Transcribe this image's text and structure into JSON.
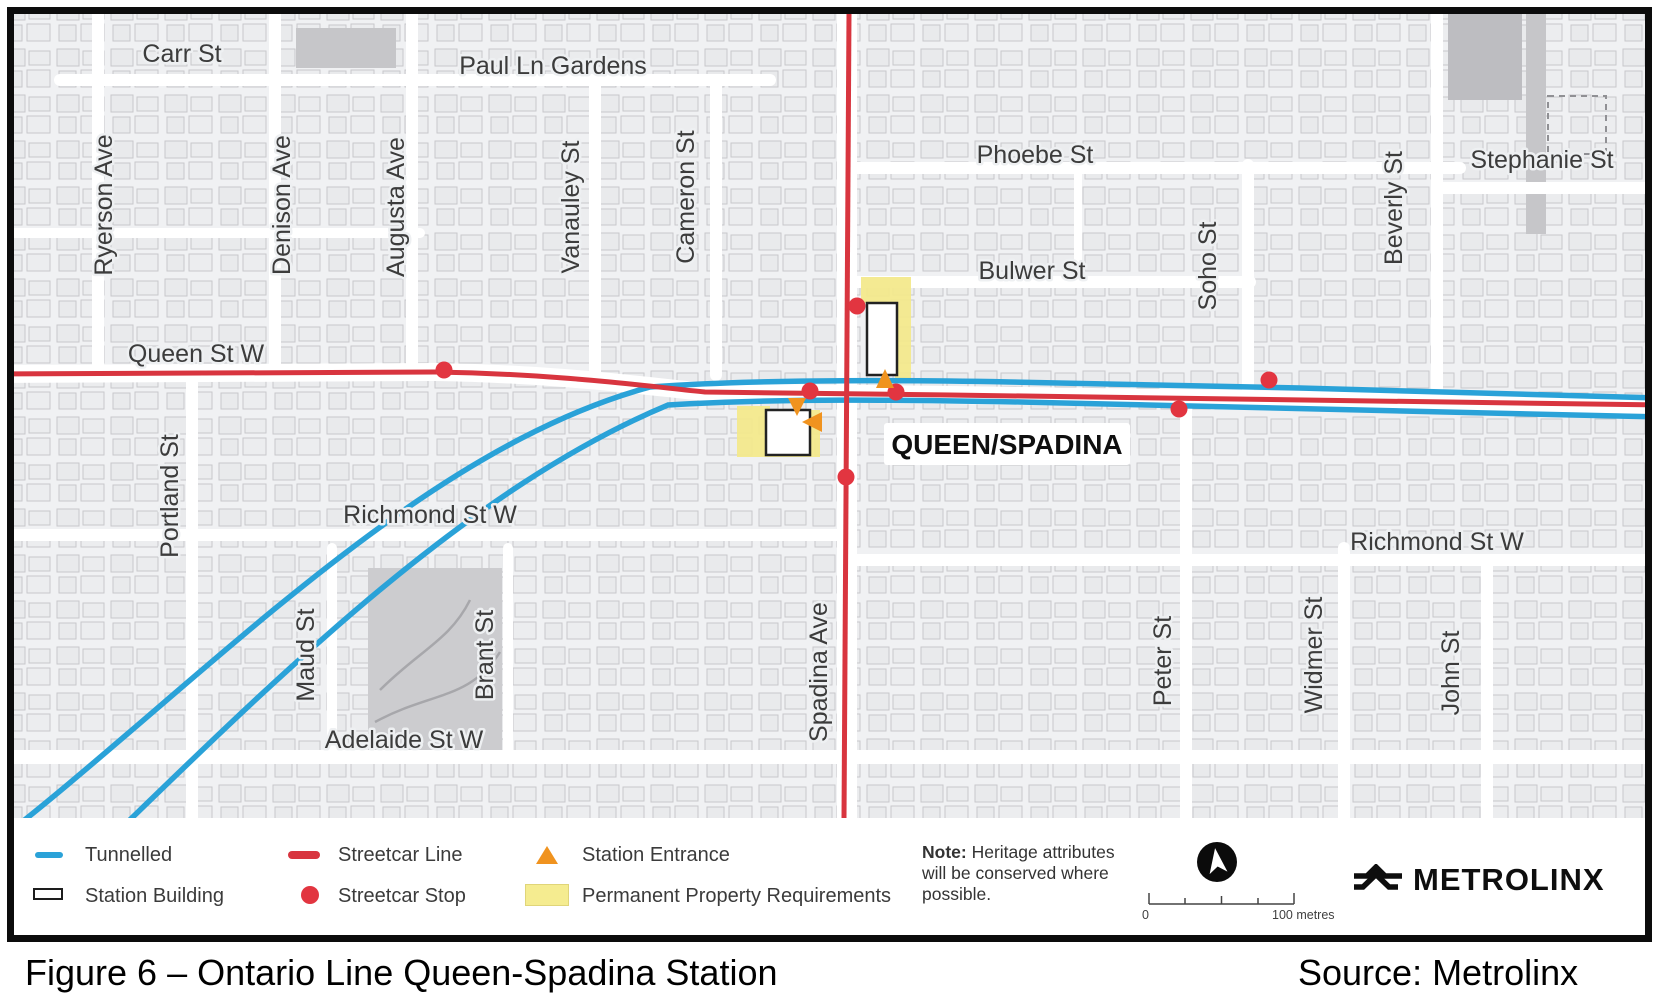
{
  "figure": {
    "caption": "Figure 6 – Ontario Line Queen-Spadina Station",
    "source": "Source: Metrolinx"
  },
  "station": {
    "name": "QUEEN/SPADINA"
  },
  "colors": {
    "tunnel_blue": "#2aa2d8",
    "streetcar_red": "#d8353f",
    "stop_red": "#e23540",
    "entrance_orange": "#f0931f",
    "property_yellow": "#f3e98c",
    "building_outline": "#222222"
  },
  "legend": {
    "items": [
      {
        "id": "tunnelled",
        "label": "Tunnelled"
      },
      {
        "id": "station-building",
        "label": "Station Building"
      },
      {
        "id": "streetcar-line",
        "label": "Streetcar Line"
      },
      {
        "id": "streetcar-stop",
        "label": "Streetcar Stop"
      },
      {
        "id": "station-entrance",
        "label": "Station Entrance"
      },
      {
        "id": "permanent-property",
        "label": "Permanent Property Requirements"
      }
    ],
    "note_bold": "Note:",
    "note_rest": " Heritage attributes will be conserved where possible.",
    "scale": {
      "start_label": "0",
      "end_label": "100 metres"
    },
    "logo_text": "METROLINX"
  },
  "map": {
    "street_labels": [
      {
        "text": "Carr St",
        "x": 182,
        "y": 62,
        "vertical": false
      },
      {
        "text": "Paul Ln Gardens",
        "x": 553,
        "y": 74,
        "vertical": false
      },
      {
        "text": "Phoebe St",
        "x": 1035,
        "y": 163,
        "vertical": false
      },
      {
        "text": "Stephanie St",
        "x": 1542,
        "y": 168,
        "vertical": false
      },
      {
        "text": "Bulwer St",
        "x": 1032,
        "y": 279,
        "vertical": false
      },
      {
        "text": "Queen St W",
        "x": 196,
        "y": 362,
        "vertical": false
      },
      {
        "text": "Richmond St W",
        "x": 430,
        "y": 523,
        "vertical": false
      },
      {
        "text": "Richmond St W",
        "x": 1437,
        "y": 550,
        "vertical": false
      },
      {
        "text": "Adelaide St W",
        "x": 404,
        "y": 748,
        "vertical": false
      },
      {
        "text": "Ryerson Ave",
        "x": 112,
        "y": 205,
        "vertical": true
      },
      {
        "text": "Denison Ave",
        "x": 290,
        "y": 205,
        "vertical": true
      },
      {
        "text": "Augusta Ave",
        "x": 404,
        "y": 207,
        "vertical": true
      },
      {
        "text": "Vanauley St",
        "x": 579,
        "y": 207,
        "vertical": true
      },
      {
        "text": "Cameron St",
        "x": 694,
        "y": 197,
        "vertical": true
      },
      {
        "text": "Portland St",
        "x": 178,
        "y": 496,
        "vertical": true
      },
      {
        "text": "Maud St",
        "x": 314,
        "y": 655,
        "vertical": true
      },
      {
        "text": "Brant St",
        "x": 493,
        "y": 655,
        "vertical": true
      },
      {
        "text": "Spadina Ave",
        "x": 827,
        "y": 672,
        "vertical": true
      },
      {
        "text": "Soho St",
        "x": 1216,
        "y": 266,
        "vertical": true
      },
      {
        "text": "Beverly St",
        "x": 1402,
        "y": 208,
        "vertical": true
      },
      {
        "text": "Peter St",
        "x": 1171,
        "y": 661,
        "vertical": true
      },
      {
        "text": "Widmer St",
        "x": 1322,
        "y": 655,
        "vertical": true
      },
      {
        "text": "John St",
        "x": 1459,
        "y": 673,
        "vertical": true
      }
    ],
    "tunnel_lines": [
      {
        "d": "M-20,855 C190,695 410,452 650,387 C760,379 900,380 1010,382 L1300,388 L1659,398"
      },
      {
        "d": "M45,902 C235,720 445,498 668,405 C780,398 910,400 1020,402 L1659,417"
      }
    ],
    "streetcar_lines": [
      {
        "d": "M-10,374 L435,372 C560,374 645,386 705,392 L950,395 L1659,405"
      },
      {
        "d": "M849,14 L844,818"
      }
    ],
    "streetcar_stops": [
      {
        "x": 444,
        "y": 370
      },
      {
        "x": 857,
        "y": 306
      },
      {
        "x": 810,
        "y": 391
      },
      {
        "x": 896,
        "y": 392
      },
      {
        "x": 846,
        "y": 477
      },
      {
        "x": 1179,
        "y": 409
      },
      {
        "x": 1269,
        "y": 380
      }
    ],
    "station_buildings": [
      {
        "x": 867,
        "y": 303,
        "w": 30,
        "h": 72
      },
      {
        "x": 766,
        "y": 410,
        "w": 44,
        "h": 45
      }
    ],
    "property_areas": [
      {
        "d": "M861,277 H911 V378 H895 V303 H861 Z"
      },
      {
        "d": "M737,406 H770 V410 H820 V457 H737 Z"
      }
    ],
    "entrances": [
      {
        "points": "885,369 894,388 876,388"
      },
      {
        "points": "788,398 806,398 797,416"
      },
      {
        "points": "802,422 822,412 822,432"
      }
    ],
    "station_label_box": {
      "x": 884,
      "y": 423,
      "w": 246,
      "h": 42
    }
  }
}
